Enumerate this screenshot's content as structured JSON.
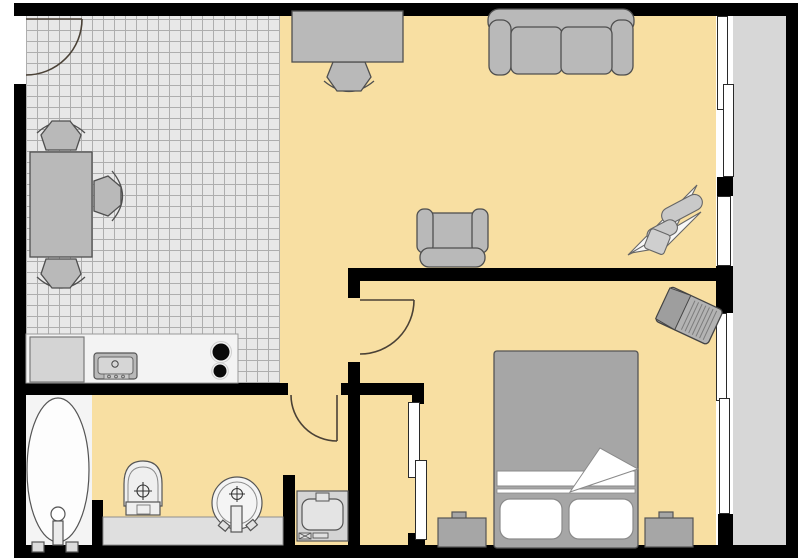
{
  "plan": {
    "title": "One-bedroom apartment floor plan",
    "view": "top-down architectural drawing",
    "rooms": {
      "kitchen": {
        "name": "Kitchen / dining area",
        "floor": "gray tile grid",
        "items": [
          "entrance-door",
          "dining-table",
          "dining-chair-north",
          "dining-chair-south",
          "dining-chair-east",
          "kitchen-counter",
          "fridge",
          "kitchen-sink",
          "stove-two-burners"
        ]
      },
      "living_room": {
        "name": "Living room",
        "floor": "yellow",
        "items": [
          "desk",
          "desk-chair",
          "sofa-two-seat",
          "armchair",
          "plant"
        ]
      },
      "bedroom": {
        "name": "Bedroom",
        "floor": "yellow",
        "items": [
          "double-bed",
          "pillow-left",
          "pillow-right",
          "folded-sheet-corner",
          "nightstand-left",
          "nightstand-right",
          "corner-tv",
          "closet-nook-with-sliding-door"
        ]
      },
      "bathroom": {
        "name": "Bathroom",
        "floor": "yellow with white bathtub nook",
        "items": [
          "bathtub",
          "tub-drain",
          "tub-faucet",
          "toilet",
          "wash-basin",
          "vanity-counter",
          "washing-machine"
        ]
      },
      "balcony": {
        "name": "Balcony / loggia",
        "floor": "gray",
        "items": []
      }
    },
    "doors": {
      "entrance": "hinged door in left wall, opens into kitchen",
      "bathroom": "hinged door in bathroom top wall, opens into bathroom",
      "bedroom": "hinged door in hallway wall, opens into bedroom",
      "closet": "sliding two-panel door on bedroom closet nook"
    },
    "windows": {
      "living_room_sliding": "two overlapping sashes, upper right wall",
      "living_room_single": "single sash, right wall",
      "bedroom_sliding": "two overlapping sashes, lower right wall"
    },
    "counts": {
      "stove_burners": 2,
      "dining_chairs": 3,
      "sofa_seats": 2,
      "pillows": 2,
      "nightstands": 2
    }
  },
  "colors": {
    "wall": "#000000",
    "floor": "#f8dfa2",
    "tile": "#e8e8e8",
    "tile_line": "#aeaeae",
    "balcony": "#d7d7d7",
    "furn": "#b9b9b9",
    "furn_dark": "#a6a6a6",
    "outline": "#4f4f4f",
    "fixture": "#f4f4f4",
    "fixture_line": "#555555",
    "door_arc": "#4a4136",
    "window": "#ffffff",
    "counter": "#f3f3f3",
    "bath_counter": "#dfdfdf",
    "burner": "#0a0a0a",
    "white": "#ffffff"
  }
}
